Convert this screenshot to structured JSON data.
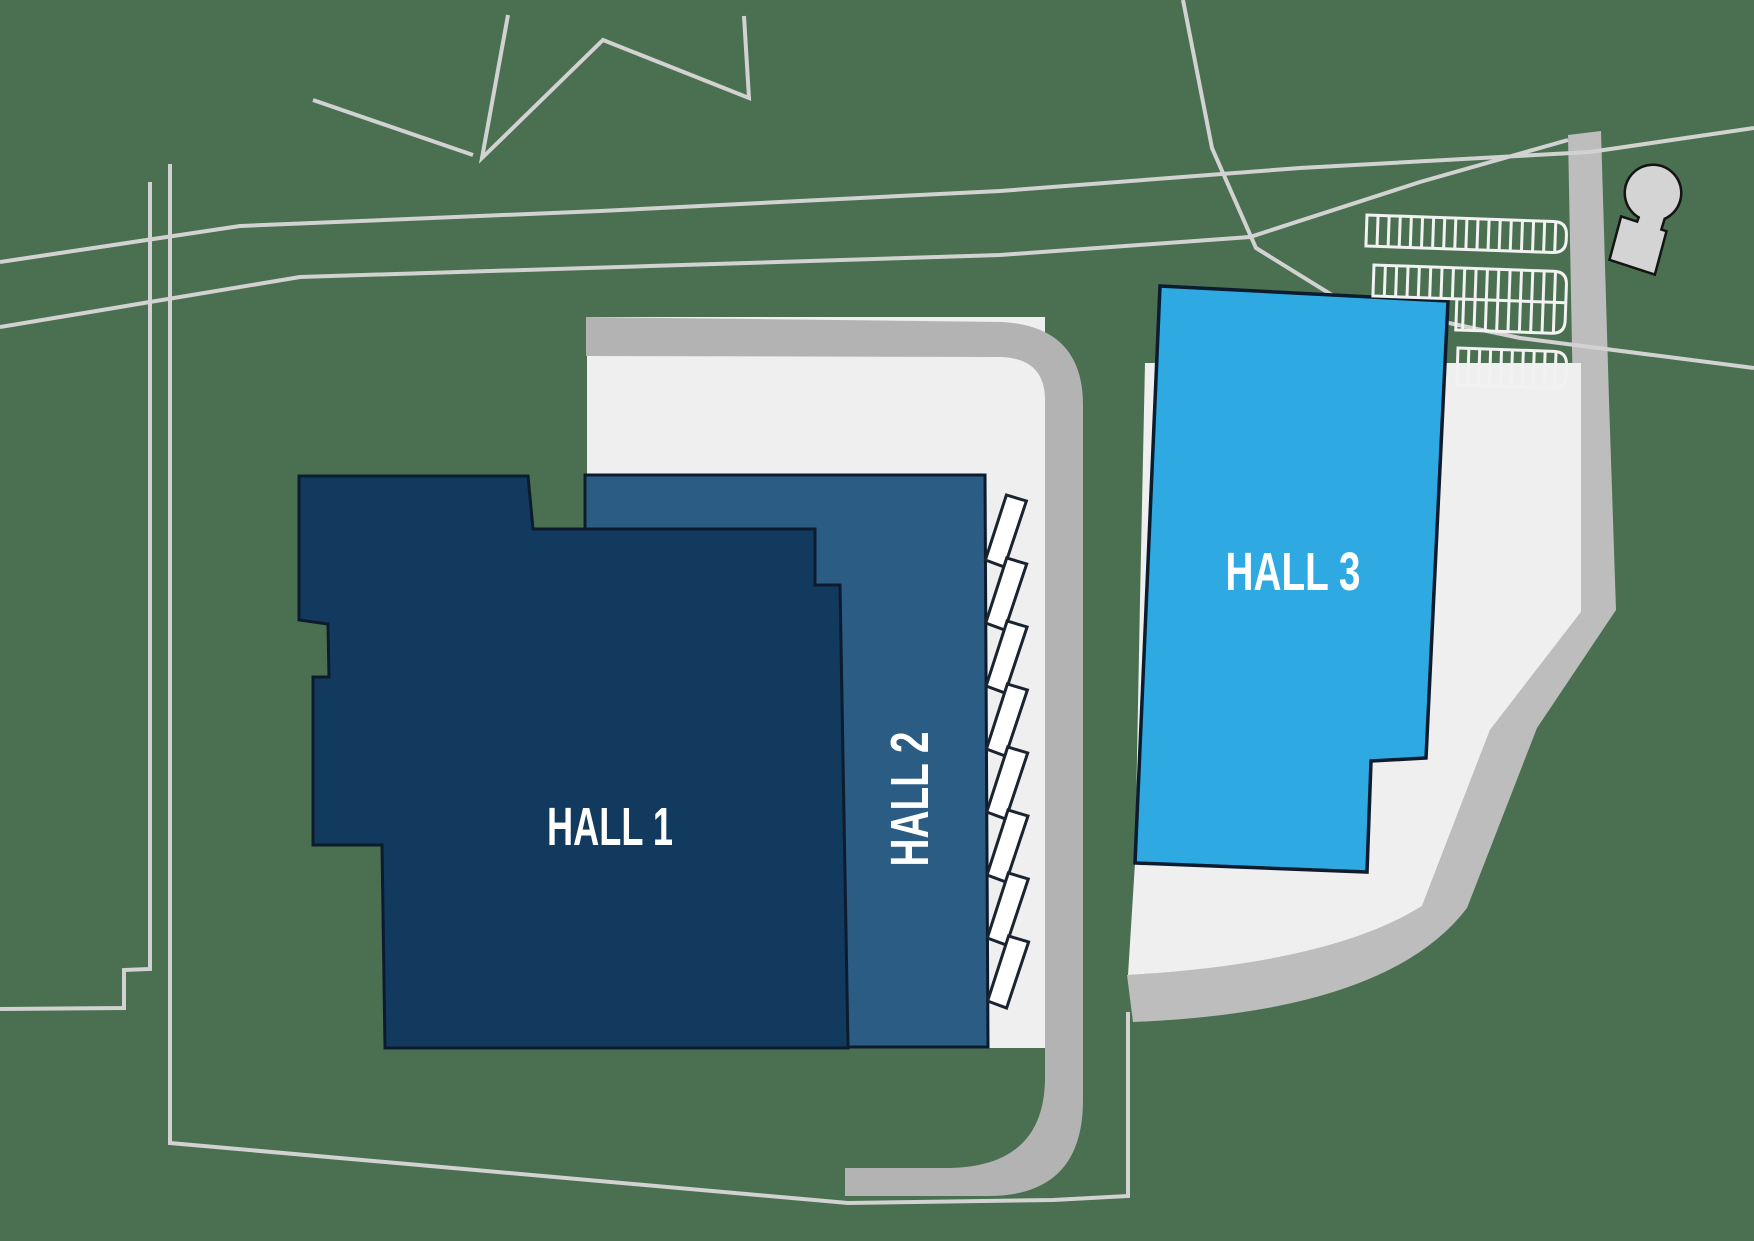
{
  "map": {
    "title": "Exhibition site plan",
    "halls": [
      {
        "id": "hall-1",
        "label": "HALL 1"
      },
      {
        "id": "hall-2",
        "label": "HALL 2"
      },
      {
        "id": "hall-3",
        "label": "HALL 3"
      }
    ]
  },
  "parking": {
    "rows": [
      {
        "stalls": 18,
        "type": "single"
      },
      {
        "stalls": 17,
        "type": "double"
      },
      {
        "stalls": 10,
        "type": "single"
      }
    ]
  },
  "docks": {
    "count": 8
  },
  "landmarks": {
    "water_tower": "water-tower"
  },
  "colors": {
    "ground": "#4a7051",
    "hall1": "#123a5e",
    "hall2": "#2a5c84",
    "hall3": "#2ea9e2",
    "hallStroke": "#0d1b2e",
    "pavement": "#efefef",
    "ringRoad": "#b3b3b3",
    "sideRoad": "#bdbdbd",
    "boundaryLine": "#d2d2d2",
    "dockFill": "#ffffff",
    "dockStroke": "#1a2430",
    "towerFill": "#d4d4d4",
    "towerStroke": "#141414",
    "parkingStroke": "#f2f2f2",
    "labelColor": "#ffffff"
  }
}
